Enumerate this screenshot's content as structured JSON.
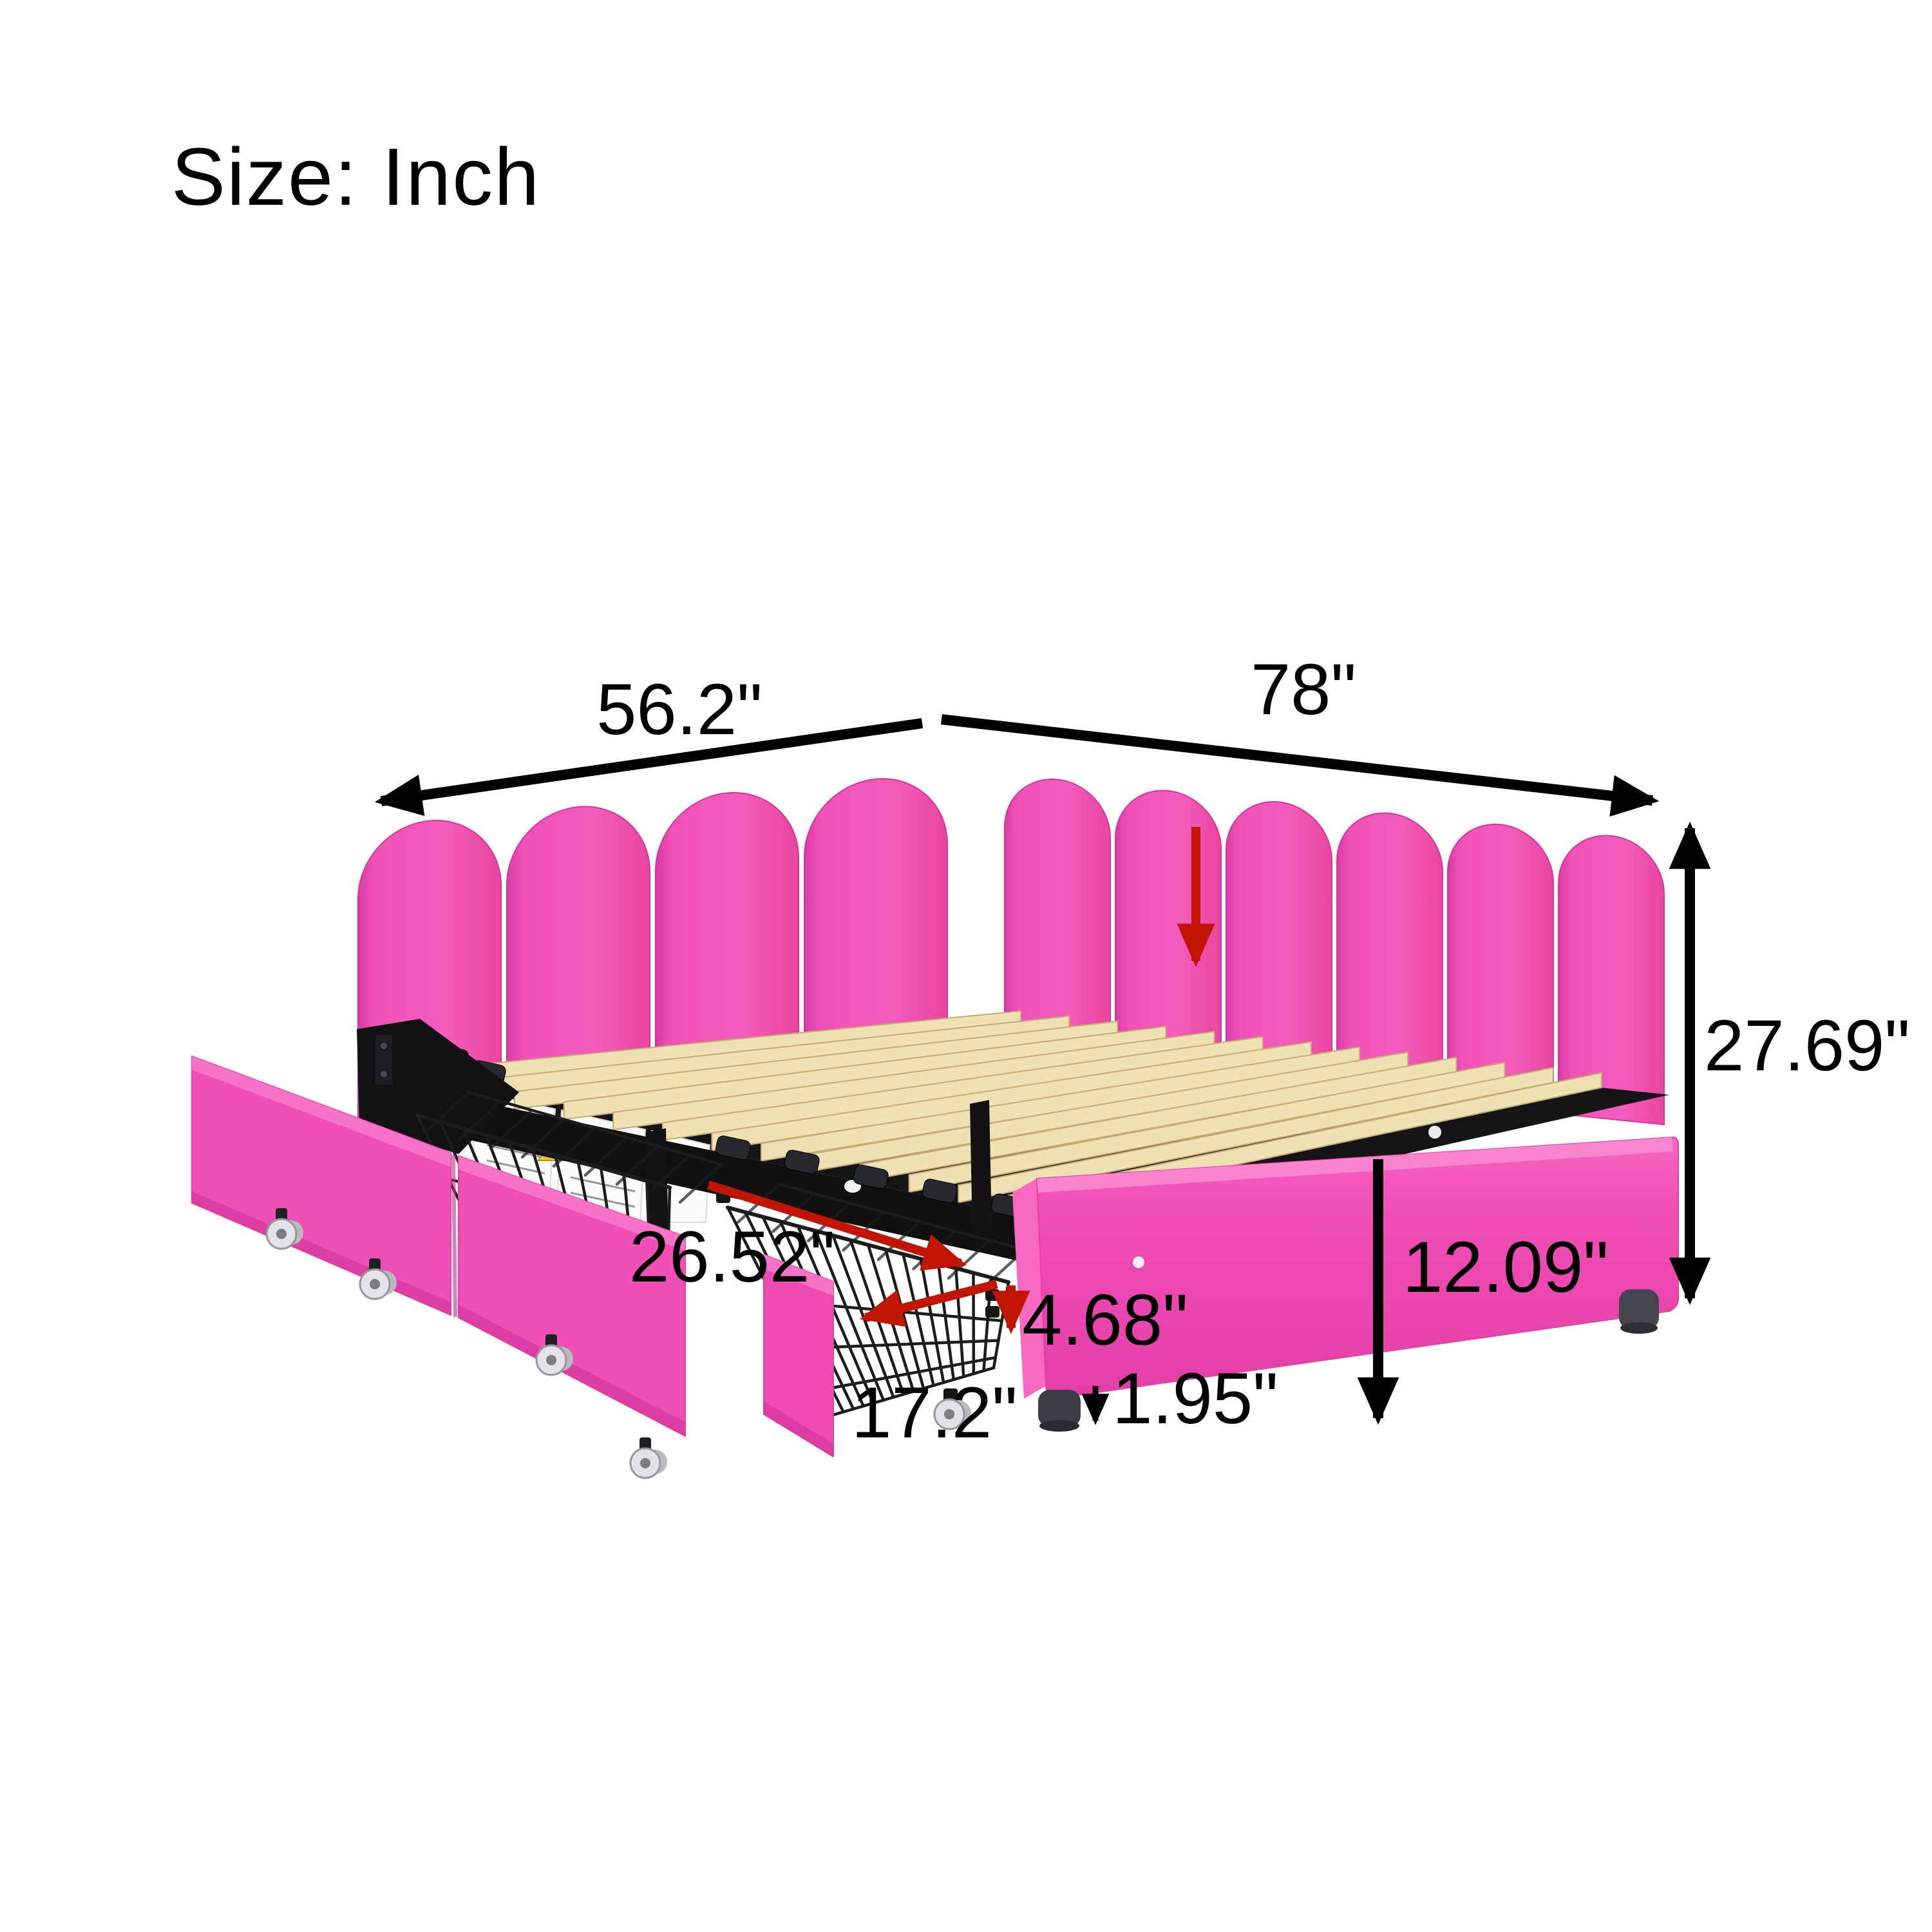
{
  "page": {
    "size_label": "Size: Inch"
  },
  "diagram": {
    "type": "product-dimension-diagram",
    "subject": "pink upholstered corner daybed with scalloped headboard, wood slats and pull-out wire basket storage drawers",
    "unit": "inch",
    "dimensions": {
      "headboard_end_width": "56.2\"",
      "bed_length": "78\"",
      "total_height": "27.69\"",
      "side_rail_height": "12.09\"",
      "drawer_depth": "26.52\"",
      "drawer_basket_height": "4.68\"",
      "drawer_width": "17.2\"",
      "leg_height": "1.95\""
    },
    "colors": {
      "upholstery_pink": "#f04fb5",
      "upholstery_pink_light": "#f877c9",
      "upholstery_pink_shadow": "#d93aa1",
      "slat_wood": "#efe1b4",
      "frame_black": "#131316",
      "leg_gray": "#3c3d44",
      "dimension_black": "#000000",
      "dimension_red": "#c11403",
      "background": "#ffffff"
    }
  }
}
